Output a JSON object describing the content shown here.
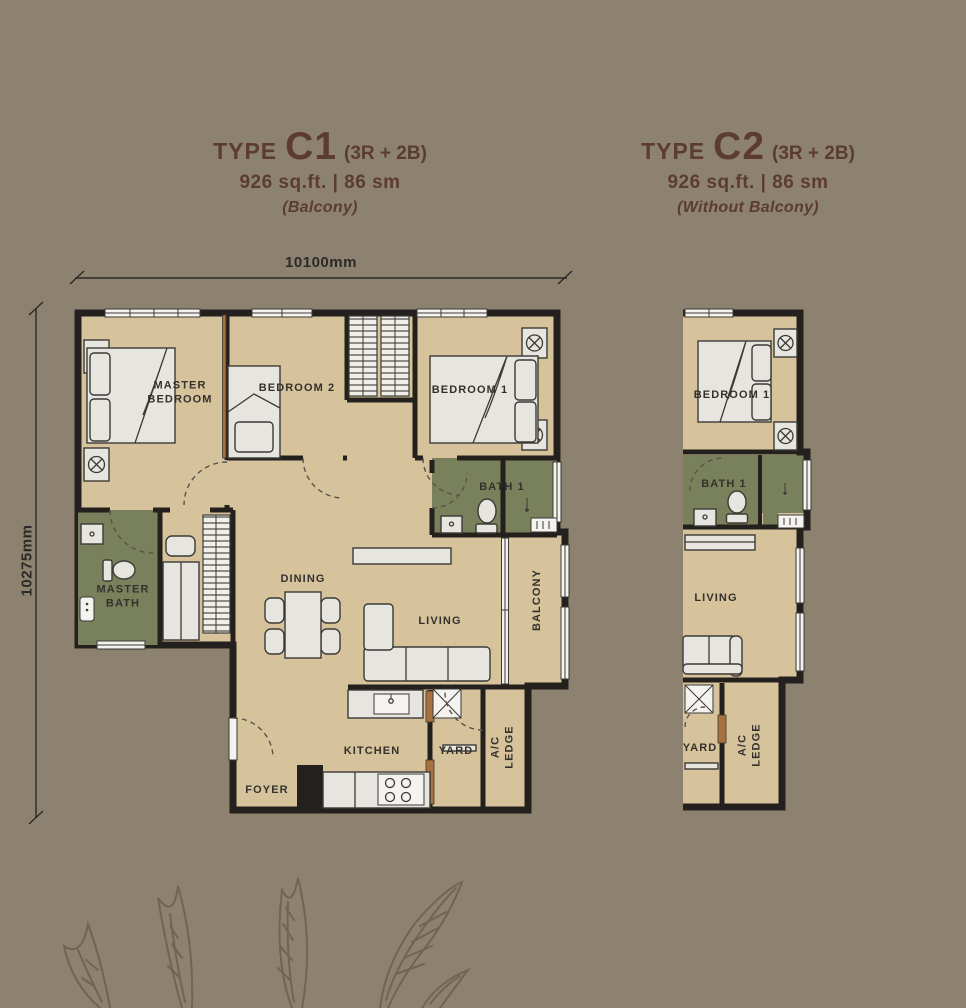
{
  "titles": {
    "c1": {
      "type_label": "TYPE",
      "code": "C1",
      "config": "(3R + 2B)",
      "area": "926 sq.ft. | 86 sm",
      "note": "(Balcony)"
    },
    "c2": {
      "type_label": "TYPE",
      "code": "C2",
      "config": "(3R + 2B)",
      "area": "926 sq.ft. | 86 sm",
      "note": "(Without Balcony)"
    }
  },
  "dimensions": {
    "width": "10100mm",
    "height": "10275mm"
  },
  "c1_rooms": {
    "master_bedroom": "MASTER BEDROOM",
    "bedroom_2": "BEDROOM 2",
    "bedroom_1": "BEDROOM 1",
    "bath_1": "BATH 1",
    "master_bath": "MASTER BATH",
    "dining": "DINING",
    "living": "LIVING",
    "balcony": "BALCONY",
    "kitchen": "KITCHEN",
    "yard": "YARD",
    "ac_ledge": "A/C LEDGE",
    "foyer": "FOYER"
  },
  "c2_rooms": {
    "bedroom_1": "BEDROOM 1",
    "bath_1": "BATH 1",
    "living": "LIVING",
    "yard": "YARD",
    "ac_ledge": "A/C LEDGE"
  },
  "colors": {
    "background": "#8d8270",
    "floor_tan": "#d6c39c",
    "wet_area_green": "#79815c",
    "wall_dark": "#23201d",
    "door_brown": "#a9713d",
    "title_brown": "#5c3c2f",
    "label_dark": "#33312c",
    "furniture_light": "#e7e5e0",
    "window_white": "#f4f3f0",
    "leaf_brown": "#6a604e"
  }
}
